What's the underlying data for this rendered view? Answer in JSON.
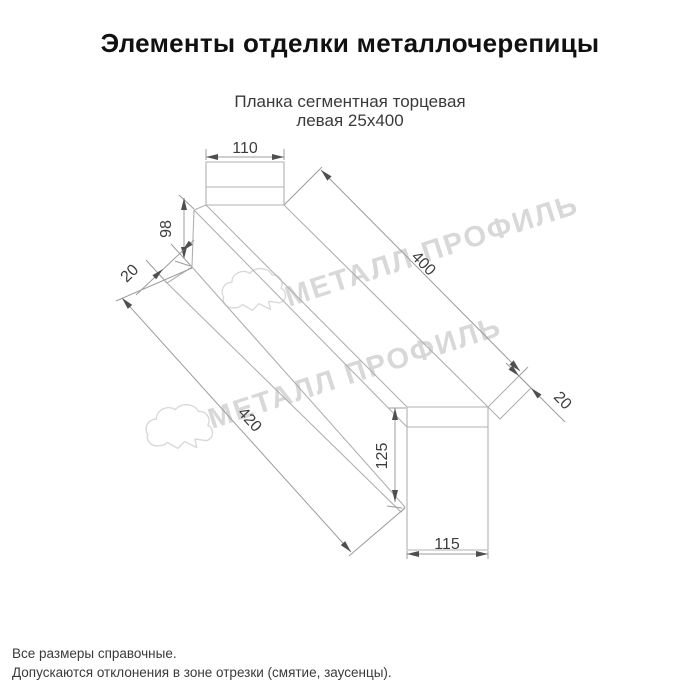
{
  "page": {
    "title": "Элементы отделки металлочерепицы",
    "subtitle_line1": "Планка сегментная торцевая",
    "subtitle_line2": "левая 25х400",
    "footnote1": "Все размеры справочные.",
    "footnote2": "Допускаются отклонения в зоне отрезки (смятие, заусенцы)."
  },
  "watermark": {
    "text": "МЕТАЛЛ ПРОФИЛЬ"
  },
  "drawing": {
    "type": "technical-sketch",
    "part_name": "Планка сегментная торцевая левая 25х400",
    "dimensions": {
      "top_flange_width": "110",
      "left_end_height": "98",
      "left_hem": "20",
      "top_length": "400",
      "bottom_length": "420",
      "right_hem": "20",
      "right_end_height": "125",
      "bottom_flange_width": "115"
    }
  },
  "colors": {
    "background": "#ffffff",
    "shape_line": "#b0b0b0",
    "dim_line": "#9c9c9c",
    "dim_text": "#3d3d3d",
    "arrow": "#4f4f4f",
    "title_text": "#111111",
    "body_text": "#3a3a3a",
    "watermark": "#d8d8d8"
  }
}
